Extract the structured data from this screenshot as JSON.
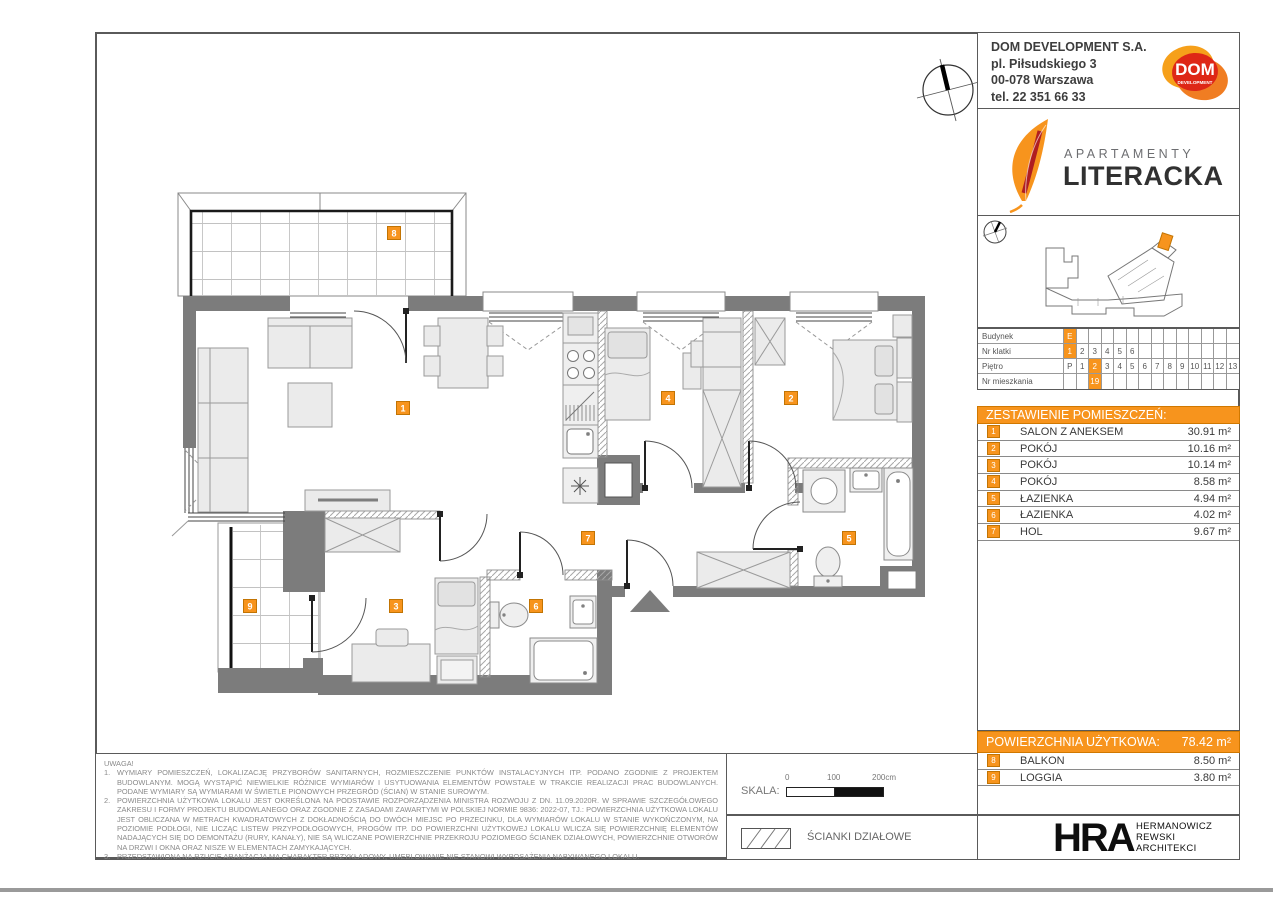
{
  "company": {
    "name": "DOM DEVELOPMENT S.A.",
    "address1": "pl. Piłsudskiego 3",
    "address2": "00-078 Warszawa",
    "phone": "tel. 22 351 66 33",
    "logo_text": "DOM",
    "logo_subtext": "DEVELOPMENT"
  },
  "project": {
    "line1": "APARTAMENTY",
    "line2": "LITERACKA"
  },
  "info_table": {
    "budynek": {
      "label": "Budynek",
      "value": "E"
    },
    "klatki": {
      "label": "Nr klatki",
      "values": [
        "1",
        "2",
        "3",
        "4",
        "5",
        "6"
      ],
      "selected": "1"
    },
    "pietro": {
      "label": "Piętro",
      "values": [
        "P",
        "1",
        "2",
        "3",
        "4",
        "5",
        "6",
        "7",
        "8",
        "9",
        "10",
        "11",
        "12",
        "13"
      ],
      "selected": "2"
    },
    "mieszkanie": {
      "label": "Nr mieszkania",
      "value": "19"
    }
  },
  "rooms_header": "ZESTAWIENIE POMIESZCZEŃ:",
  "rooms": [
    {
      "no": "1",
      "name": "SALON Z ANEKSEM",
      "area": "30.91 m²"
    },
    {
      "no": "2",
      "name": "POKÓJ",
      "area": "10.16 m²"
    },
    {
      "no": "3",
      "name": "POKÓJ",
      "area": "10.14 m²"
    },
    {
      "no": "4",
      "name": "POKÓJ",
      "area": "8.58 m²"
    },
    {
      "no": "5",
      "name": "ŁAZIENKA",
      "area": "4.94 m²"
    },
    {
      "no": "6",
      "name": "ŁAZIENKA",
      "area": "4.02 m²"
    },
    {
      "no": "7",
      "name": "HOL",
      "area": "9.67 m²"
    }
  ],
  "area_summary": {
    "label": "POWIERZCHNIA UŻYTKOWA:",
    "value": "78.42 m²"
  },
  "outdoor": [
    {
      "no": "8",
      "name": "BALKON",
      "area": "8.50 m²"
    },
    {
      "no": "9",
      "name": "LOGGIA",
      "area": "3.80 m²"
    }
  ],
  "notes": {
    "title": "UWAGA!",
    "items": [
      {
        "num": "1.",
        "text": "WYMIARY POMIESZCZEŃ, LOKALIZACJĘ PRZYBORÓW SANITARNYCH, ROZMIESZCZENIE PUNKTÓW INSTALACYJNYCH ITP. PODANO ZGODNIE Z PROJEKTEM BUDOWLANYM. MOGĄ WYSTĄPIĆ NIEWIELKIE RÓŻNICE WYMIARÓW I USYTUOWANIA ELEMENTÓW POWSTAŁE W TRAKCIE REALIZACJI PRAC BUDOWLANYCH. PODANE WYMIARY SĄ WYMIARAMI W ŚWIETLE PIONOWYCH PRZEGRÓD (ŚCIAN) W STANIE SUROWYM."
      },
      {
        "num": "2.",
        "text": "POWIERZCHNIA UŻYTKOWA LOKALU JEST OKREŚLONA NA PODSTAWIE ROZPORZĄDZENIA MINISTRA ROZWOJU Z DN. 11.09.2020R. W SPRAWIE SZCZEGÓŁOWEGO ZAKRESU I FORMY PROJEKTU BUDOWLANEGO ORAZ ZGODNIE Z ZASADAMI ZAWARTYMI W POLSKIEJ NORMIE 9836: 2022-07, TJ.: POWIERZCHNIA UŻYTKOWA LOKALU JEST OBLICZANA W METRACH KWADRATOWYCH Z DOKŁADNOŚCIĄ DO DWÓCH MIEJSC PO PRZECINKU, DLA WYMIARÓW LOKALU W STANIE WYKOŃCZONYM, NA POZIOMIE PODŁOGI, NIE LICZĄC LISTEW PRZYPODŁOGOWYCH, PROGÓW ITP. DO POWIERZCHNI UŻYTKOWEJ LOKALU WLICZA SIĘ POWIERZCHNIĘ ELEMENTÓW NADAJĄCYCH SIĘ DO DEMONTAŻU (RURY, KANAŁY), NIE SĄ WLICZANE POWIERZCHNIE PRZEKROJU POZIOMEGO ŚCIANEK DZIAŁOWYCH, POWIERZCHNIE OTWORÓW NA DRZWI I OKNA ORAZ NISZE W ELEMENTACH ZAMYKAJĄCYCH."
      },
      {
        "num": "3.",
        "text": "PRZEDSTAWIONA NA RZUCIE ARANŻACJA MA CHARAKTER PRZYKŁADOWY, UMEBLOWANIE NIE STANOWI WYPOSAŻENIA NABYWANEGO LOKALU."
      }
    ]
  },
  "scale": {
    "label": "SKALA:",
    "tick0": "0",
    "tick100": "100",
    "tick200": "200cm"
  },
  "legend": {
    "partition_walls": "ŚCIANKI DZIAŁOWE"
  },
  "architect": {
    "logo": "HRA",
    "line1": "HERMANOWICZ",
    "line2": "REWSKI",
    "line3": "ARCHITEKCI"
  },
  "plan": {
    "badges": [
      "1",
      "2",
      "3",
      "4",
      "5",
      "6",
      "7",
      "8",
      "9"
    ]
  },
  "colors": {
    "accent": "#F7941D",
    "wall": "#7c7c7c"
  }
}
